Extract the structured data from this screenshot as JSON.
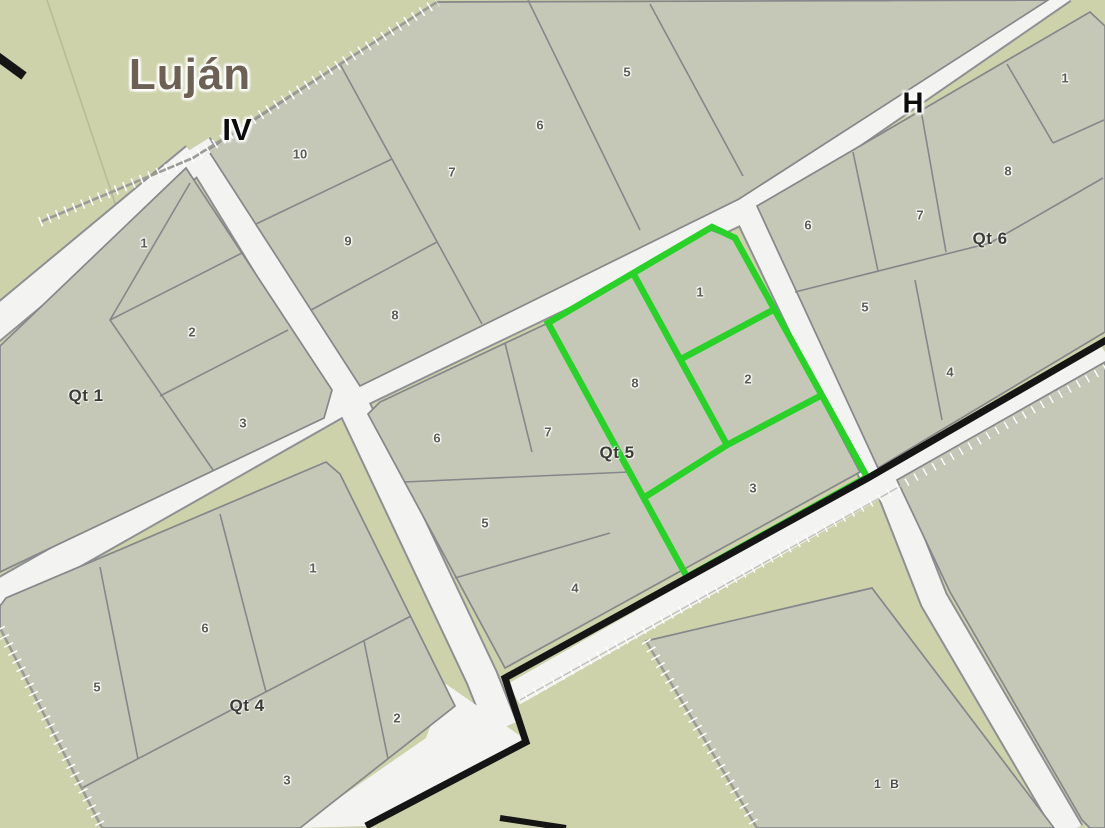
{
  "map": {
    "locality_label": "Luján",
    "sector_label": "IV",
    "street_label": "H",
    "colors": {
      "background": "#cdd2ab",
      "parcel_fill": "#c5c8b7",
      "road_fill": "#f3f4f1",
      "parcel_border": "#85878a",
      "highlight_green": "#29d129",
      "boundary_black": "#151515",
      "locality_text": "#6d6156"
    },
    "blocks": [
      {
        "key": "north-block",
        "label": "",
        "parcels": [
          "10",
          "9",
          "8",
          "7",
          "6",
          "5"
        ]
      },
      {
        "key": "qt1",
        "label": "Qt 1",
        "parcels": [
          "1",
          "2",
          "3"
        ]
      },
      {
        "key": "qt5",
        "label": "Qt 5",
        "parcels": [
          "6",
          "7",
          "5",
          "4",
          "8",
          "1",
          "2",
          "3"
        ]
      },
      {
        "key": "qt4",
        "label": "Qt 4",
        "parcels": [
          "1",
          "6",
          "5",
          "2",
          "3"
        ]
      },
      {
        "key": "qt6",
        "label": "Qt 6",
        "parcels": [
          "6",
          "7",
          "8",
          "1",
          "5",
          "4"
        ]
      },
      {
        "key": "block-1b",
        "label": "",
        "parcels": [
          "1 B"
        ]
      }
    ],
    "highlight": {
      "block": "Qt 5",
      "parcels": [
        "8",
        "1",
        "2",
        "3"
      ]
    }
  }
}
